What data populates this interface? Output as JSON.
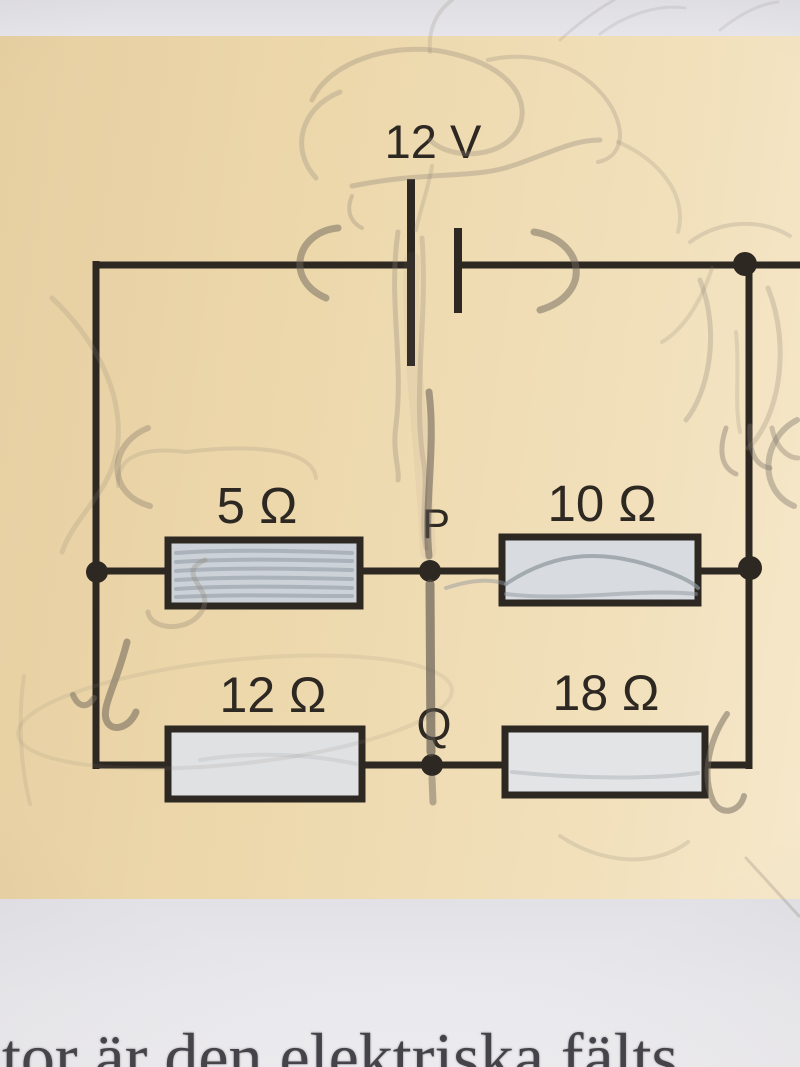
{
  "diagram": {
    "battery": {
      "label": "12 V"
    },
    "resistors": [
      {
        "position": "top-left",
        "label": "5 Ω"
      },
      {
        "position": "top-right",
        "label": "10 Ω"
      },
      {
        "position": "bottom-left",
        "label": "12 Ω"
      },
      {
        "position": "bottom-right",
        "label": "18 Ω"
      }
    ],
    "nodes": [
      {
        "label": "P"
      },
      {
        "label": "Q"
      }
    ]
  },
  "caption": {
    "visible_fragment": "tor är den elektriska fälts"
  },
  "colors": {
    "page_beige": "#edd8ac",
    "page_margin": "#e3e2e7",
    "ink": "#2e2823",
    "pencil": "#877e72",
    "resistor_fill": "#d8dce0",
    "caption_text": "#45434a"
  }
}
